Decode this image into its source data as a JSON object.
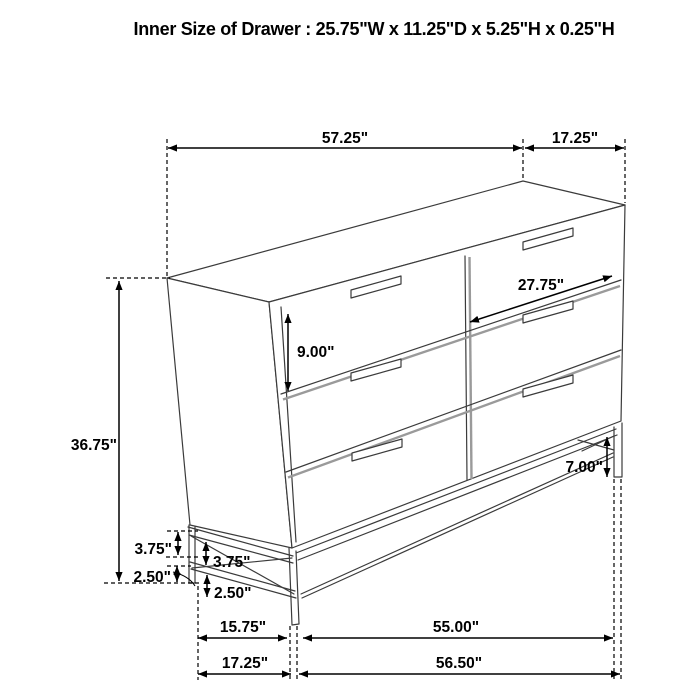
{
  "title": "Inner Size of Drawer : 25.75\"W x 11.25\"D x 5.25\"H x 0.25\"H",
  "dims": {
    "top_width": "57.25\"",
    "top_depth": "17.25\"",
    "overall_height": "36.75\"",
    "drawer_height": "9.00\"",
    "drawer_width": "27.75\"",
    "right_leg_height": "7.00\"",
    "side_rail_a": "3.75\"",
    "side_rail_b": "3.75\"",
    "foot_a": "2.50\"",
    "foot_b": "2.50\"",
    "base_left_span": "15.75\"",
    "base_front_inner": "55.00\"",
    "base_depth": "17.25\"",
    "base_front_outer": "56.50\""
  },
  "colors": {
    "background": "#ffffff",
    "furniture_line": "#3b3b3b",
    "dimension_line": "#000000",
    "shadow_line": "#9a9a9a",
    "text": "#000000"
  }
}
